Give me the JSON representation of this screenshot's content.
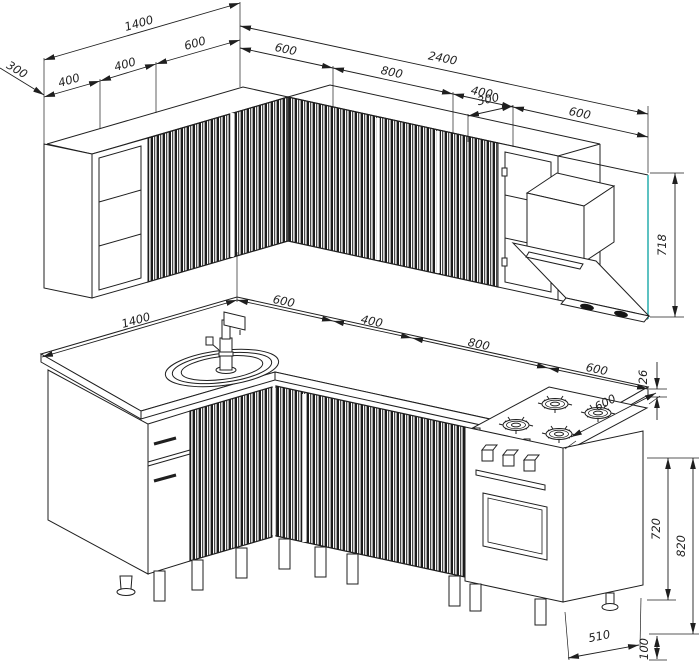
{
  "drawing_type": "kitchen-furniture-technical-drawing",
  "views": {
    "upper": "wall-cabinets-axonometric",
    "lower": "base-cabinets-axonometric"
  },
  "dims": {
    "upper": {
      "side_depth": "300",
      "left_total": "1400",
      "left_seg_a": "400",
      "left_seg_b": "400",
      "left_seg_c": "600",
      "right_total": "2400",
      "right_seg_a": "600",
      "right_seg_b": "800",
      "right_seg_c": "400",
      "hood_inset": "300",
      "right_seg_d": "600",
      "cabinet_height": "718"
    },
    "lower": {
      "left_total": "1400",
      "seg_a": "600",
      "seg_b": "400",
      "seg_c": "800",
      "seg_d": "600",
      "hob_depth": "600",
      "worktop_thickness": "26",
      "cabinet_height": "720",
      "worktop_height": "820",
      "stove_depth": "510",
      "leg_height": "100"
    }
  },
  "colors": {
    "line": "#1f1f1f",
    "accent_teal": "#35b2b2",
    "background": "#ffffff"
  }
}
